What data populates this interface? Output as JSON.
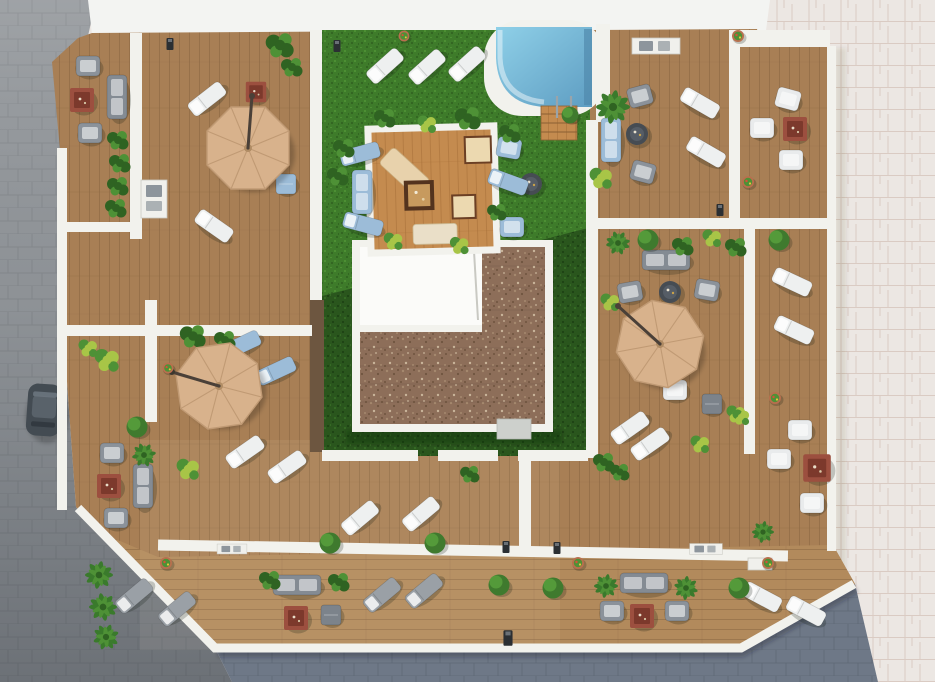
{
  "scene": {
    "title": "rooftop-terrace-aerial-render",
    "description": "Aerial 3D architectural rendering of an apartment building rooftop: wooden deck terraces divided by white walls, central lawn with pebble-roof core, small swimming pool with wooden steps, pergola deck platform, three tan cantilever umbrellas, sun loungers, lounge furniture, plants, surrounded by gray cobblestone streets (left, bottom) and pale paved plaza (right), with a parked car at the left curb",
    "view": "top-down",
    "style": "3d-render",
    "no_visible_text": true
  },
  "colors": {
    "paverLight": "#ece7e3",
    "paverLine": "#d3bfb6",
    "cobbleGray": "#94989c",
    "cobbleGrayDark": "#7b8085",
    "cobbleBlue": "#6e7887",
    "cobbleBlueDark": "#59636f",
    "topBand": "#f3f4f2",
    "wallWhite": "#f2f2ed",
    "woodBase": "#a87f55",
    "woodLine": "#86633f",
    "woodLight": "#b28a5c",
    "woodPlatform": "#c48b4f",
    "woodPlatformLine": "#a76f38",
    "corridorWood": "#6d5640",
    "grassLight": "#3e7b2a",
    "grassLightDot": "#336722",
    "grassLightDot2": "#4c8f33",
    "grassDark": "#2a561d",
    "grassDarkDot": "#1f4415",
    "grassDarkDot2": "#356b24",
    "gravelBase": "#8d6e59",
    "gravelDot1": "#a5886e",
    "gravelDot2": "#6f543f",
    "gravelDot3": "#c9b49a",
    "poolLight": "#8fd0e8",
    "poolDeep": "#5e9dc2",
    "poolEdge": "#4f87ab",
    "umbrella": "#d8b28c",
    "umbrellaLine": "#c09a74",
    "umbrellaPole": "#4a4038",
    "loungerWhite": "#eef0f0",
    "loungerGray": "#9aa0a6",
    "loungerBlue": "#9cbcd8",
    "chairGray": "#8b929a",
    "chairWhite": "#e9ebec",
    "sofaGray": "#848b93",
    "tableRed": "#9c4f3f",
    "tableRedDark": "#7c392c",
    "tableRoundDark": "#464c53",
    "stoolGray": "#7c838b",
    "bushGreen": "#3f7a2e",
    "bushLight": "#58a03c",
    "plantDark": "#2f6322",
    "plantMid": "#4e9136",
    "plantYellow": "#a8c547",
    "palmGreen": "#3a7a2c",
    "potTerracotta": "#b96f4e",
    "roofWhite": "#fbfbf9",
    "boxGray": "#cdd0cc",
    "carBody": "#434b52"
  },
  "inventory": {
    "umbrellas": 3,
    "pools": 1,
    "pergola_platforms": 1,
    "sun_loungers_white": 17,
    "sun_loungers_gray": 4,
    "sun_loungers_blue": 5,
    "armchairs_gray": 10,
    "armchairs_white": 7,
    "sofas": 7,
    "fire_tables_red": 7,
    "round_tables": 3,
    "stools_poufs": 3,
    "topiary_bushes": 9,
    "flower_pots": 7,
    "palm_plants": 9,
    "plant_clusters": 22,
    "outdoor_kitchens": 4,
    "path_lights": 6,
    "cars": 1
  },
  "areas": {
    "center": "lawn-with-core-roof-and-pebble-gravel",
    "top_center": "pool-and-pergola-lounge-lawn",
    "top_left": "umbrella-terrace",
    "top_right": "lounge-terrace",
    "middle_left": "umbrella-terrace",
    "middle_right": "umbrella-terrace",
    "bottom": "lounger-terrace-strip",
    "left": "cobblestone-street-with-parked-car",
    "right": "paved-plaza",
    "bottom_edge": "cobblestone-street"
  }
}
